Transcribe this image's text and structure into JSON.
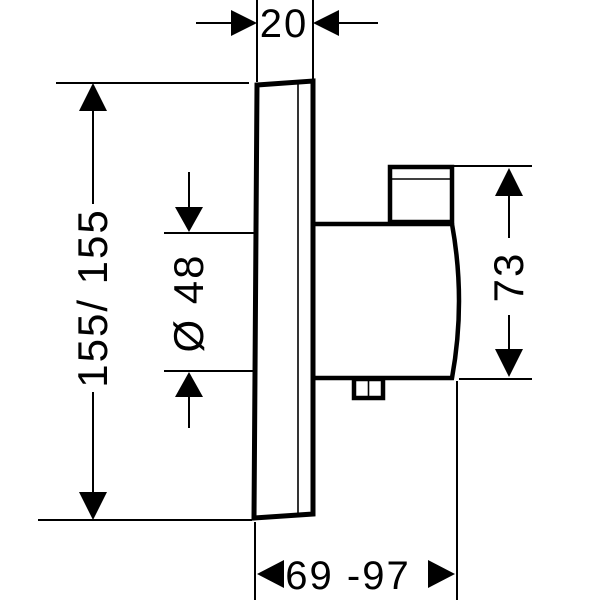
{
  "labels": {
    "plate_thickness": "20",
    "plate_dimensions": "155/ 155",
    "cartridge_diameter": "Ø 48",
    "body_height": "73",
    "installation_depth": "69 -97"
  },
  "colors": {
    "line": "#000000",
    "background": "#ffffff"
  }
}
